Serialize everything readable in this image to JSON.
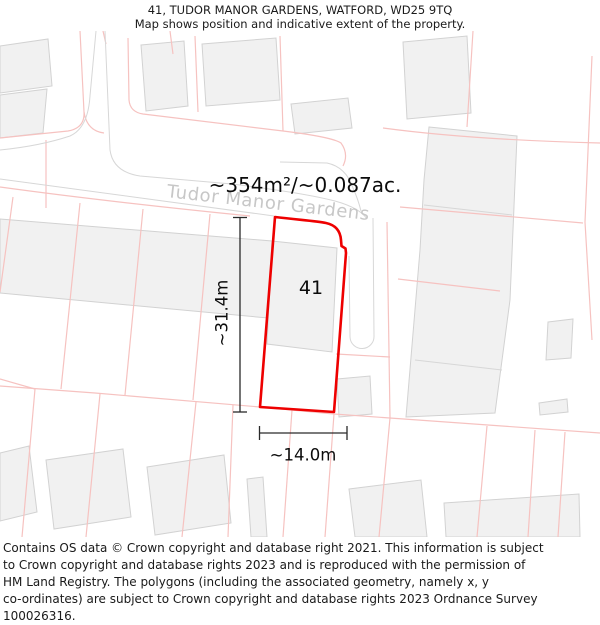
{
  "header": {
    "title": "41, TUDOR MANOR GARDENS, WATFORD, WD25 9TQ",
    "subtitle": "Map shows position and indicative extent of the property."
  },
  "map": {
    "street_label": "Tudor Manor Gardens",
    "area_label": "~354m²/~0.087ac.",
    "plot_number": "41",
    "height_label": "~31.4m",
    "width_label": "~14.0m",
    "colors": {
      "property_boundary_red": "#ee0000",
      "parcel_line_pink": "#f6c2c0",
      "building_fill": "#f1f1f1",
      "building_stroke": "#d2d2d2",
      "road_line_gray": "#d7d7d7",
      "dimension_black": "#2a2a2a",
      "street_text_gray": "#c7c7c7"
    }
  },
  "footer": {
    "lines": [
      "Contains OS data © Crown copyright and database right 2021. This information is subject",
      "to Crown copyright and database rights 2023 and is reproduced with the permission of",
      "HM Land Registry. The polygons (including the associated geometry, namely x, y",
      "co-ordinates) are subject to Crown copyright and database rights 2023 Ordnance Survey",
      "100026316."
    ]
  }
}
